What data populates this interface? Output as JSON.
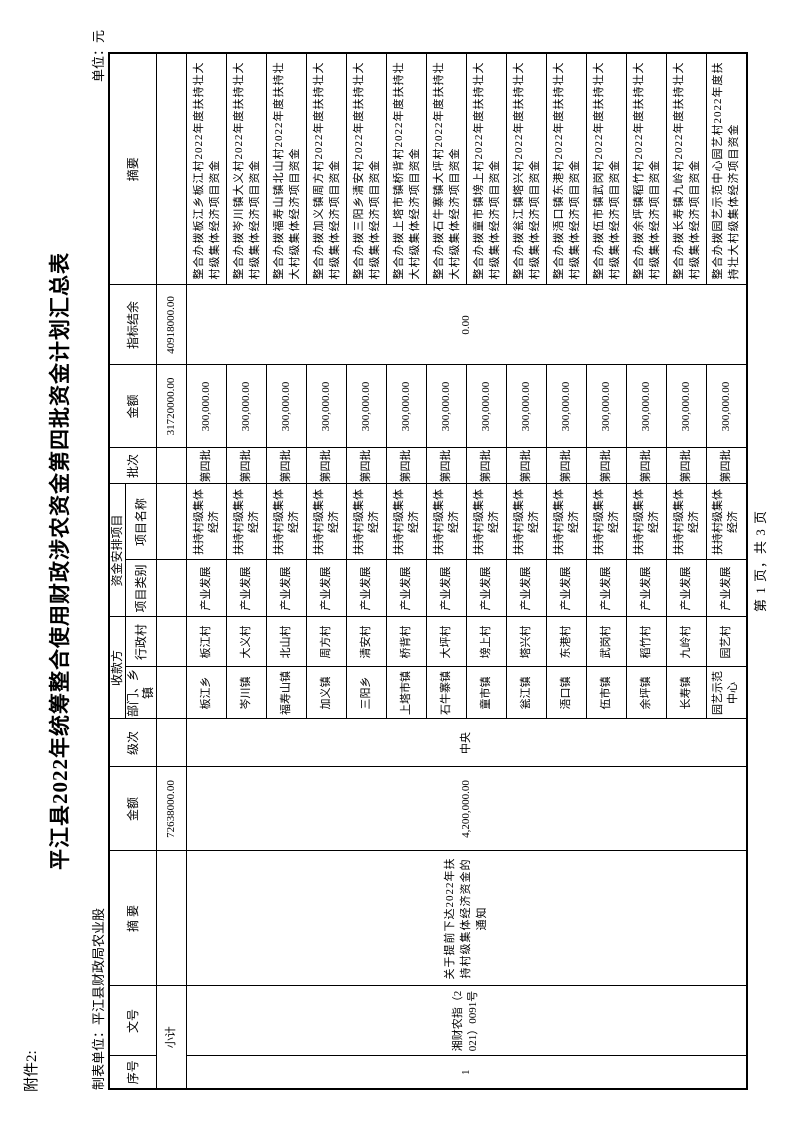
{
  "page": {
    "attachment_label": "附件2:",
    "title": "平江县2022年统筹整合使用财政涉农资金第四批资金计划汇总表",
    "maker_label": "制表单位：平江县财政局农业股",
    "unit_label": "单位：元",
    "footer": "第 1 页，共 3 页"
  },
  "table": {
    "headers": {
      "seq": "序号",
      "doc_no": "文号",
      "remark_source": "摘  要",
      "amount_source": "金额",
      "level": "级次",
      "payee_group": "收款方",
      "payee_dept": "部门、乡镇",
      "payee_village": "行政村",
      "project_group": "资金安排项目",
      "project_category": "项目类别",
      "project_name": "项目名称",
      "batch": "批次",
      "amount_arranged": "金额",
      "balance": "指标结余",
      "remark_detail": "摘要"
    },
    "subtotal": {
      "label": "小计",
      "amount_source": "72638000.00",
      "amount_arranged": "31720000.00",
      "balance": "40918000.00"
    },
    "group": {
      "seq": "1",
      "doc_no": "湘财农指（2021）0091号",
      "remark": "关于提前下达2022年扶持村级集体经济资金的通知",
      "amount": "4,200,000.00",
      "level": "中央",
      "balance": "0.00"
    },
    "rows": [
      {
        "dept": "板江乡",
        "village": "板江村",
        "category": "产业发展",
        "project": "扶持村级集体经济",
        "batch": "第四批",
        "amount": "300,000.00",
        "remark": "整合办拨板江乡板江村2022年度扶持壮大村级集体经济项目资金"
      },
      {
        "dept": "岑川镇",
        "village": "大义村",
        "category": "产业发展",
        "project": "扶持村级集体经济",
        "batch": "第四批",
        "amount": "300,000.00",
        "remark": "整合办拨岑川镇大义村2022年度扶持壮大村级集体经济项目资金"
      },
      {
        "dept": "福寿山镇",
        "village": "北山村",
        "category": "产业发展",
        "project": "扶持村级集体经济",
        "batch": "第四批",
        "amount": "300,000.00",
        "remark": "整合办拨福寿山镇北山村2022年度扶持壮大村级集体经济项目资金"
      },
      {
        "dept": "加义镇",
        "village": "周方村",
        "category": "产业发展",
        "project": "扶持村级集体经济",
        "batch": "第四批",
        "amount": "300,000.00",
        "remark": "整合办拨加义镇周方村2022年度扶持壮大村级集体经济项目资金"
      },
      {
        "dept": "三阳乡",
        "village": "清安村",
        "category": "产业发展",
        "project": "扶持村级集体经济",
        "batch": "第四批",
        "amount": "300,000.00",
        "remark": "整合办拨三阳乡清安村2022年度扶持壮大村级集体经济项目资金"
      },
      {
        "dept": "上塔市镇",
        "village": "桥背村",
        "category": "产业发展",
        "project": "扶持村级集体经济",
        "batch": "第四批",
        "amount": "300,000.00",
        "remark": "整合办拨上塔市镇桥背村2022年度扶持壮大村级集体经济项目资金"
      },
      {
        "dept": "石牛寨镇",
        "village": "大坪村",
        "category": "产业发展",
        "project": "扶持村级集体经济",
        "batch": "第四批",
        "amount": "300,000.00",
        "remark": "整合办拨石牛寨镇大坪村2022年度扶持壮大村级集体经济项目资金"
      },
      {
        "dept": "童市镇",
        "village": "塝上村",
        "category": "产业发展",
        "project": "扶持村级集体经济",
        "batch": "第四批",
        "amount": "300,000.00",
        "remark": "整合办拨童市镇塝上村2022年度扶持壮大村级集体经济项目资金"
      },
      {
        "dept": "瓮江镇",
        "village": "塔兴村",
        "category": "产业发展",
        "project": "扶持村级集体经济",
        "batch": "第四批",
        "amount": "300,000.00",
        "remark": "整合办拨瓮江镇塔兴村2022年度扶持壮大村级集体经济项目资金"
      },
      {
        "dept": "浯口镇",
        "village": "东港村",
        "category": "产业发展",
        "project": "扶持村级集体经济",
        "batch": "第四批",
        "amount": "300,000.00",
        "remark": "整合办拨浯口镇东港村2022年度扶持壮大村级集体经济项目资金"
      },
      {
        "dept": "伍市镇",
        "village": "武岗村",
        "category": "产业发展",
        "project": "扶持村级集体经济",
        "batch": "第四批",
        "amount": "300,000.00",
        "remark": "整合办拨伍市镇武岗村2022年度扶持壮大村级集体经济项目资金"
      },
      {
        "dept": "余坪镇",
        "village": "稻竹村",
        "category": "产业发展",
        "project": "扶持村级集体经济",
        "batch": "第四批",
        "amount": "300,000.00",
        "remark": "整合办拨余坪镇稻竹村2022年度扶持壮大村级集体经济项目资金"
      },
      {
        "dept": "长寿镇",
        "village": "九岭村",
        "category": "产业发展",
        "project": "扶持村级集体经济",
        "batch": "第四批",
        "amount": "300,000.00",
        "remark": "整合办拨长寿镇九岭村2022年度扶持壮大村级集体经济项目资金"
      },
      {
        "dept": "园艺示范中心",
        "village": "园艺村",
        "category": "产业发展",
        "project": "扶持村级集体经济",
        "batch": "第四批",
        "amount": "300,000.00",
        "remark": "整合办拨园艺示范中心园艺村2022年度扶持壮大村级集体经济项目资金"
      }
    ]
  }
}
